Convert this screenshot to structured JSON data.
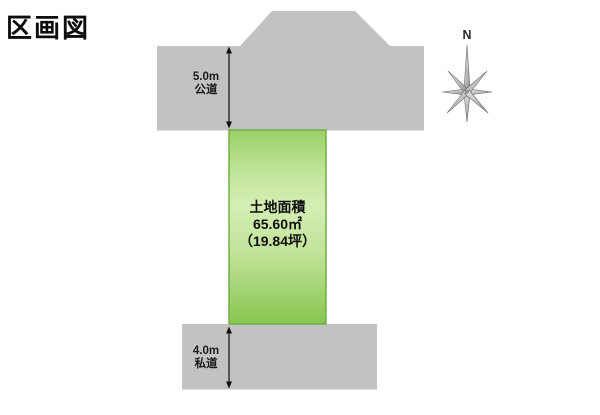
{
  "page": {
    "title": "区画図"
  },
  "plot": {
    "label_title": "土地面積",
    "area_sqm": "65.60㎡",
    "area_tsubo": "（19.84坪）",
    "fill_top": "#9bd067",
    "fill_center": "#d5eeb5",
    "fill_bottom": "#88c64f",
    "border_color": "#74ad46"
  },
  "roads": {
    "top": {
      "width_label": "5.0m",
      "type_label": "公道"
    },
    "bottom": {
      "width_label": "4.0m",
      "type_label": "私道"
    }
  },
  "compass": {
    "north_label": "N"
  },
  "colors": {
    "road_fill": "#c2c2c2",
    "background": "#ffffff",
    "text": "#111111",
    "dimension_arrow": "#111111"
  }
}
